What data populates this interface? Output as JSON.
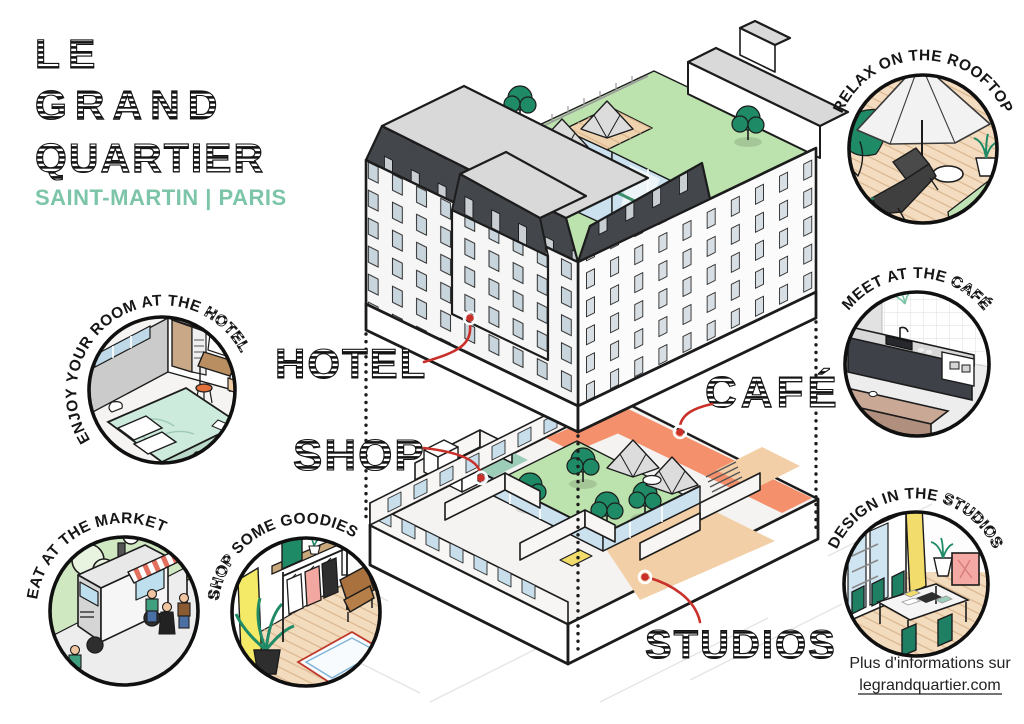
{
  "brand": {
    "line1": "LE",
    "line2": "GRAND",
    "line3": "QUARTIER",
    "subtitle": "SAINT-MARTIN | PARIS"
  },
  "labels": {
    "hotel": "HOTEL",
    "shop": "SHOP",
    "cafe": "CAFÉ",
    "studios": "STUDIOS"
  },
  "vignettes": {
    "rooftop": {
      "caption": "RELAX ON THE ROOFTOP"
    },
    "cafe": {
      "caption_prefix": "MEET AT THE ",
      "caption_styled": "CAFÉ"
    },
    "studios": {
      "caption_prefix": "DESIGN IN THE ",
      "caption_styled": "STUDIOS"
    },
    "hotel_room": {
      "caption_prefix": "ENJOY YOUR ROOM AT THE ",
      "caption_styled": "HOTEL"
    },
    "market": {
      "caption": "EAT AT THE MARKET"
    },
    "shop": {
      "caption_styled": "SHOP",
      "caption_suffix": " SOME GOODIES"
    }
  },
  "footer": {
    "info": "Plus d'informations sur",
    "link": "legrandquartier.com"
  },
  "colors": {
    "brand_teal": "#7CC5A8",
    "accent_red": "#C9302A",
    "tree_green": "#1E8A66",
    "lawn_green": "#BCE3AE",
    "cafe_orange": "#F4906B",
    "studio_peach": "#F2CFA6",
    "shop_teal": "#9CCDB9",
    "wood": "#EFD3AE",
    "roof_dark": "#43464B",
    "glass_blue": "#CBE1EE",
    "ink": "#1C1C1C"
  }
}
